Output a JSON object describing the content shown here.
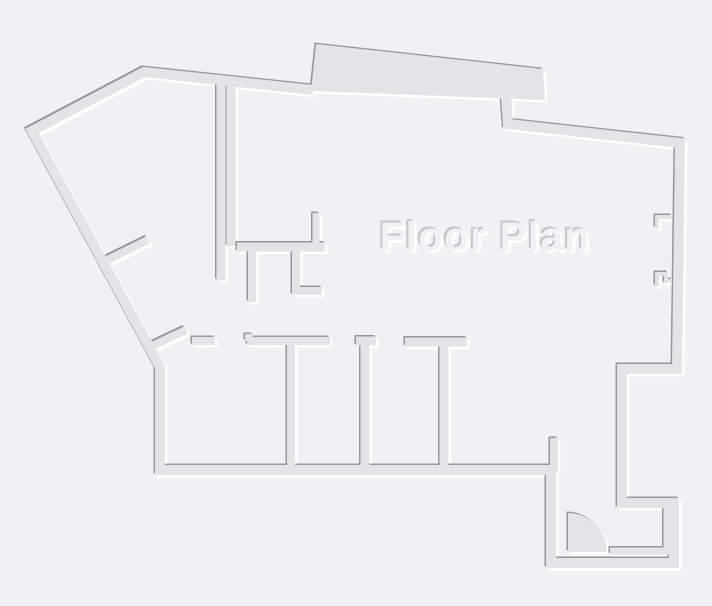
{
  "title": {
    "text": "Floor Plan"
  },
  "colors": {
    "background": "#f0f1f2",
    "wall_fill": "#e2e4e5",
    "wall_shadow_dark": "#96979a",
    "wall_highlight": "#ffffff",
    "title_shadow_dark": "#c6c7c9",
    "title_highlight": "#ffffff"
  },
  "walls": {
    "exterior_left": "M313,90 L144,72 L32,131 L160,367 L160,470 L553,470",
    "exterior_right": "M551,466 L551,563 L674,563 L674,503 L622,503 L622,369 L677,369 L680,143 L508,124 L506,97",
    "balcony_slab": "M311,91 L316,44 L543,69 L545,100 Z",
    "hall_wall_a": "M221,84 L221,280",
    "hall_wall_b": "M231,84 L231,246",
    "mid_horizontal": "M237,247 L325,247",
    "up_stub": "M316,246 L316,213",
    "down_stub": "M252,247 L252,302",
    "l_piece": "M296,247 L296,291 L322,291",
    "diag_branch_upper": "M101,263 L148,240",
    "diag_branch_lower": "M150,347 L186,330",
    "small_horizontal": "M192,341 L215,341",
    "t_partition": "M249,334 L249,341 M247,341 L330,341 M291,341 L291,466",
    "capped_partition": "M356,341 L376,341 M365,341 L365,466",
    "right_partition": "M405,342 L467,342 M444,342 L444,466",
    "corridor_stub": "M554,438 L554,472",
    "entry_inner_l": "M610,551 L667,551 L667,508",
    "window_hook_top": "M672,217 L657,217 L657,228",
    "window_hook_bottom": "M657,286 L657,274 L666,274 L666,281 L672,281",
    "door_swing": "M568,552 L568,513 A39,39 0 0 1 607,552 Z"
  }
}
